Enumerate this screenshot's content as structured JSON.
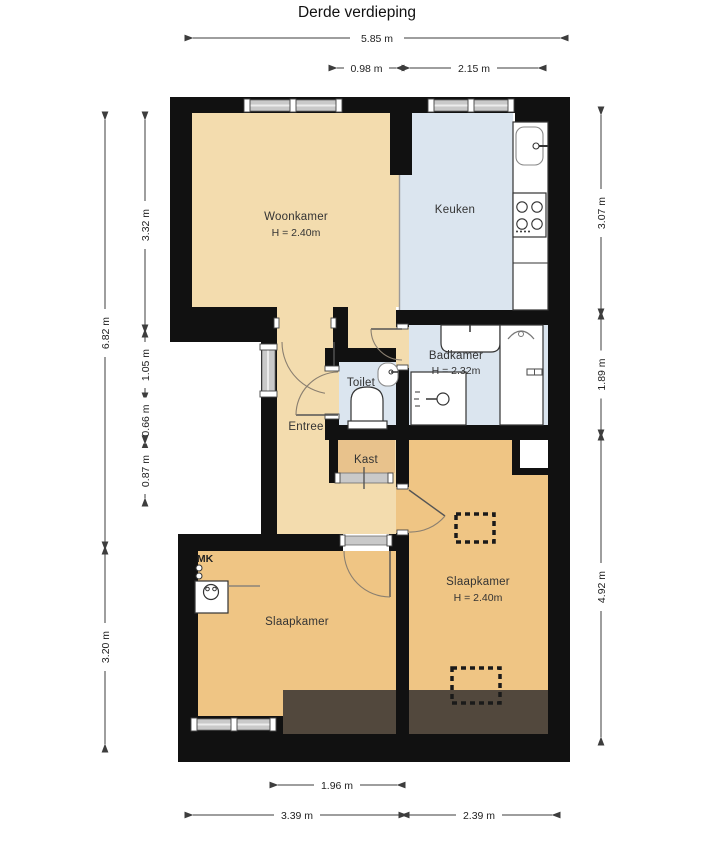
{
  "title": "Derde verdieping",
  "rooms": {
    "woonkamer": {
      "label": "Woonkamer",
      "height": "H = 2.40m"
    },
    "keuken": {
      "label": "Keuken"
    },
    "badkamer": {
      "label": "Badkamer",
      "height": "H = 2.32m"
    },
    "toilet": {
      "label": "Toilet"
    },
    "entree": {
      "label": "Entree"
    },
    "kast": {
      "label": "Kast"
    },
    "slaapkamer_links": {
      "label": "Slaapkamer"
    },
    "slaapkamer_rechts": {
      "label": "Slaapkamer",
      "height": "H = 2.40m"
    },
    "meterkast": {
      "label": "MK"
    }
  },
  "dimensions": {
    "top": [
      {
        "label": "5.85 m"
      },
      {
        "label": "0.98 m"
      },
      {
        "label": "2.15 m"
      }
    ],
    "left_outer": [
      {
        "label": "6.82 m"
      },
      {
        "label": "3.20 m"
      }
    ],
    "left_inner": [
      {
        "label": "3.32 m"
      },
      {
        "label": "1.05 m"
      },
      {
        "label": "0.66 m"
      },
      {
        "label": "0.87 m"
      }
    ],
    "right": [
      {
        "label": "3.07 m"
      },
      {
        "label": "1.89 m"
      },
      {
        "label": "4.92 m"
      }
    ],
    "bottom": [
      {
        "label": "1.96 m"
      },
      {
        "label": "3.39 m"
      },
      {
        "label": "2.39 m"
      }
    ]
  },
  "colors": {
    "wall": "#111111",
    "living_area": "#f3dcae",
    "wet_area": "#dbe5ef",
    "bedroom_area": "#efc584",
    "closet_area": "#e8c28c",
    "low_roof_area": "#52483d",
    "window_band": "#c9c9c9"
  }
}
